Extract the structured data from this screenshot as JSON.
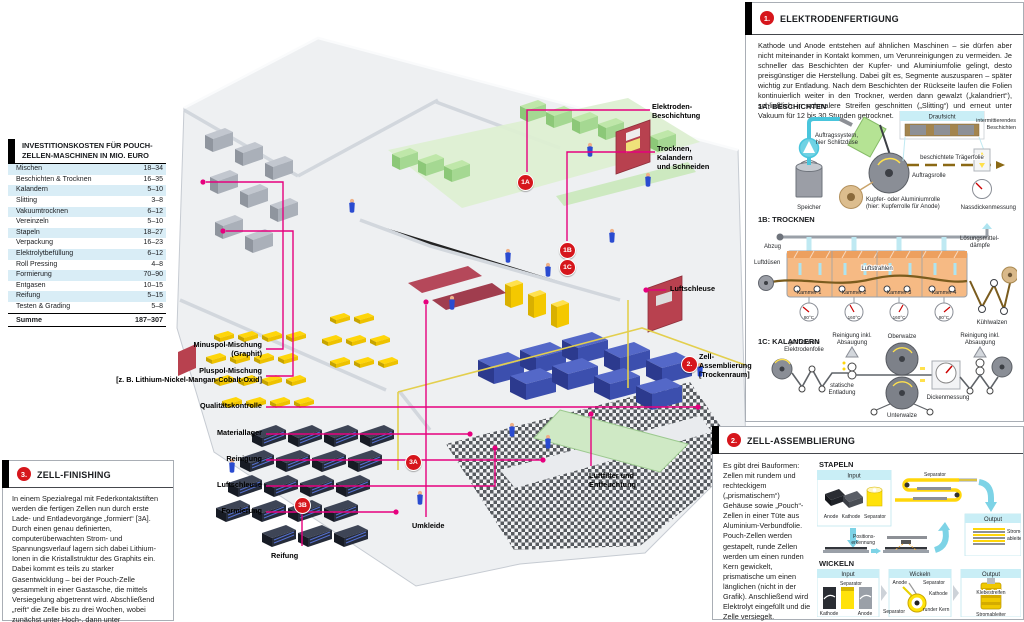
{
  "colors": {
    "magenta": "#e6007e",
    "marker_red": "#d6161c",
    "cyan_light": "#c9eef6",
    "cyan_arrow": "#7dd3e6",
    "table_alt_row": "#d9edf6"
  },
  "invest_table": {
    "title_l1": "INVESTITIONSKOSTEN FÜR POUCH-",
    "title_l2": "ZELLEN-MASCHINEN IN MIO. EURO",
    "rows": [
      {
        "label": "Mischen",
        "value": "18–34"
      },
      {
        "label": "Beschichten & Trocknen",
        "value": "16–35"
      },
      {
        "label": "Kalandern",
        "value": "5–10"
      },
      {
        "label": "Slitting",
        "value": "3–8"
      },
      {
        "label": "Vakuumtrocknen",
        "value": "6–12"
      },
      {
        "label": "Vereinzeln",
        "value": "5–10"
      },
      {
        "label": "Stapeln",
        "value": "18–27"
      },
      {
        "label": "Verpackung",
        "value": "16–23"
      },
      {
        "label": "Elektrolytbefüllung",
        "value": "6–12"
      },
      {
        "label": "Roll Pressing",
        "value": "4–8"
      },
      {
        "label": "Formierung",
        "value": "70–90"
      },
      {
        "label": "Entgasen",
        "value": "10–15"
      },
      {
        "label": "Reifung",
        "value": "5–15"
      },
      {
        "label": "Testen & Grading",
        "value": "5–8"
      }
    ],
    "sum": {
      "label": "Summe",
      "value": "187–307"
    }
  },
  "factory": {
    "left_labels": [
      {
        "l1": "Minuspol-Mischung",
        "l2": "(Graphit)"
      },
      {
        "l1": "Pluspol-Mischung",
        "l2": "[z. B. Lithium-Nickel-Mangan-Cobalt-Oxid]"
      },
      {
        "l1": "Qualitätskontrolle",
        "l2": ""
      },
      {
        "l1": "Materiallager",
        "l2": ""
      },
      {
        "l1": "Reinigung",
        "l2": ""
      },
      {
        "l1": "Luftschleuse",
        "l2": ""
      },
      {
        "l1": "Formierung",
        "l2": ""
      }
    ],
    "labels": {
      "eb1": "Elektroden-",
      "eb2": "Beschichtung",
      "tks1": "Trocknen,",
      "tks2": "Kalandern",
      "tks3": "und Schneiden",
      "luftschleuse": "Luftschleuse",
      "za1": "Zell-",
      "za2": "Assemblierung",
      "za3": "[Trockenraum]",
      "lf1": "Luftfilter und",
      "lf2": "Entfeuchtung",
      "umkleide": "Umkleide",
      "reifung": "Reifung"
    },
    "markers": {
      "m1a": "1A",
      "m1b": "1B",
      "m1c": "1C",
      "m2": "2.",
      "m3a": "3A",
      "m3b": "3B"
    }
  },
  "panel1": {
    "num": "1.",
    "title": "ELEKTRODENFERTIGUNG",
    "body": "Kathode und Anode entstehen auf ähnlichen Maschinen – sie dürfen aber nicht miteinander in Kontakt kommen, um Verunreinigungen zu vermeiden. Je schneller das Beschichten der Kupfer- und Aluminiumfolie gelingt, desto preisgünstiger die Herstellung. Dabei gilt es, Segmente auszusparen – später wichtig zur Entladung. Nach dem Beschichten der Rückseite laufen die Folien kontinuierlich weiter in den Trockner, werden dann gewalzt („kalandriert“), schließlich in schmalere Streifen geschnitten („Slitting“) und erneut unter Vakuum für 12 bis 30 Stunden getrocknet.",
    "s1a": {
      "title": "1A: BESCHICHTEN",
      "draufsicht": "Draufsicht",
      "intermittierend1": "intermittierendes",
      "intermittierend2": "Beschichten",
      "auftragssystem1": "Auftragssystem,",
      "auftragssystem2": "hier Schlitzdüse",
      "traegerfolie": "beschichtete Trägerfolie",
      "auftragsrolle": "Auftragsrolle",
      "speicher": "Speicher",
      "rolle1": "Kupfer- oder Aluminiumrolle",
      "rolle2": "(hier: Kupferrolle für Anode)",
      "nassdicke": "Nassdickenmessung"
    },
    "s1b": {
      "title": "1B: TROCKNEN",
      "abzug": "Abzug",
      "luftduesen": "Luftdüsen",
      "luftstrahlen": "Luftstrahlen",
      "loesung1": "Lösungsmittel-",
      "loesung2": "dämpfe",
      "kammern": [
        "Kammer 1",
        "Kammer 2",
        "Kammer 3",
        "Kammer 4"
      ],
      "temps": [
        "80°C",
        "160°C",
        "160°C",
        "80°C"
      ],
      "kuehlwalzen": "Kühlwalzen"
    },
    "s1c": {
      "title": "1C: KALANDERN",
      "folie1": "getrocknete",
      "folie2": "Elektrodenfolie",
      "reinigung1": "Reinigung inkl.",
      "reinigung2": "Absaugung",
      "statisch1": "statische",
      "statisch2": "Entladung",
      "oberwalze": "Oberwalze",
      "unterwalze": "Unterwalze",
      "dicke": "Dickenmessung"
    }
  },
  "panel2": {
    "num": "2.",
    "title": "ZELL-ASSEMBLIERUNG",
    "body": "Es gibt drei Bauformen: Zellen mit rundem und rechteckigem („prismatischem“) Gehäuse sowie „Pouch“-Zellen in einer Tüte aus Aluminium-Verbundfolie. Pouch-Zellen werden gestapelt, runde Zellen werden um einen runden Kern gewickelt, prismatische um einen länglichen (nicht in der Grafik). Anschließend wird Elektrolyt eingefüllt und die Zelle versiegelt.",
    "stapeln": {
      "title": "STAPELN",
      "input": "Input",
      "anode": "Anode",
      "kathode": "Kathode",
      "separator": "Separator",
      "separator_fold": "Separator",
      "position1": "Positions-",
      "position2": "erkennung",
      "output": "Output",
      "strom1": "Strom-",
      "strom2": "ableiter"
    },
    "wickeln": {
      "title": "WICKELN",
      "input": "Input",
      "separator_top": "Separator",
      "kathode": "Kathode",
      "anode": "Anode",
      "wtitle": "Wickeln",
      "w_anode": "Anode",
      "w_sep1": "Separator",
      "w_kathode": "Kathode",
      "w_sep2": "Separator",
      "kern": "runder Kern",
      "output": "Output",
      "kleb": "Klebestreifen",
      "stromableiter": "Stromableiter"
    }
  },
  "panel3": {
    "num": "3.",
    "title": "ZELL-FINISHING",
    "body": "In einem Spezialregal mit Federkontaktstiften werden die fertigen Zellen nun durch erste Lade- und Entladevorgänge „formiert“ [3A]. Durch einen genau definierten, computerüberwachten Strom- und Spannungsverlauf lagern sich dabei Lithium-Ionen in die Kristallstruktur des Graphits ein. Dabei kommt es teils zu starker Gasentwicklung – bei der Pouch-Zelle gesammelt in einer Gastasche, die mittels Versiegelung abgetrennt wird. Abschließend „reift“ die Zelle bis zu drei Wochen, wobei zunächst unter Hoch-, dann unter Normaltemperatur die Leerlaufspannung überwacht wird [3B]."
  }
}
